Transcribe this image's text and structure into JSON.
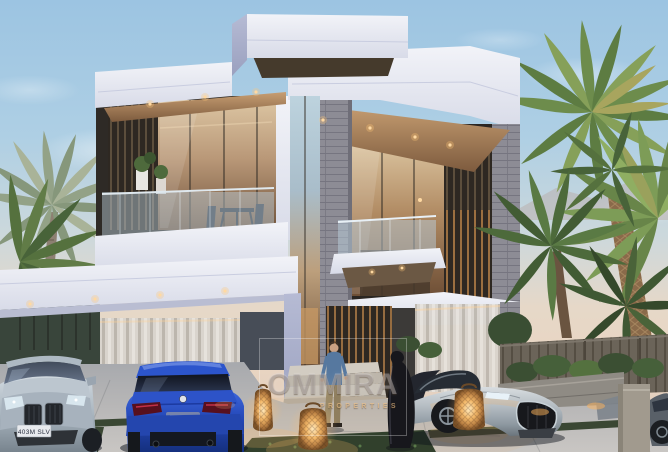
{
  "image": {
    "alt": "Dusk architectural rendering of a modern white two-storey luxury villa with glass balconies, wood-slat screens and stone piers, palm trees on both sides, a paved driveway with grass joints, glowing wicker floor lanterns, four luxury cars, a man on the entrance steps and a woman in a black abaya walking past"
  },
  "watermark": {
    "brand": "OMMIRA",
    "subtitle": "PROPERTIES"
  },
  "license_plate": "403M SLV",
  "scene": {
    "vehicles": [
      "silver BMW coupe, front view, lower left",
      "blue BMW sedan, rear view, centre left",
      "silver Bugatti-style sports car right of the entrance",
      "partially visible car at the far right edge"
    ],
    "figures": [
      "man in blue shirt and beige trousers descending the entrance steps",
      "woman in a long black abaya walking right of the entrance"
    ],
    "landscape": [
      "palm trees left and right",
      "wooden slat fence on the right",
      "stone planter wall with warm underlighting",
      "three lit wicker floor lanterns",
      "paved driveway with grass strips"
    ]
  },
  "palette": {
    "sky_top": "#9cc4e2",
    "sky_horizon": "#e9d5c2",
    "villa_white": "#e9ebf3",
    "soffit_wood": "#b08a62",
    "slat_dark": "#2e2822",
    "stone_grey": "#8d8c95",
    "glass_warm": "#b99878",
    "palm_green": "#6d8c4c",
    "driveway_grey": "#b8b7b7",
    "car_blue": "#2448b8",
    "car_silver": "#aab6c0",
    "lantern_glow": "#f3b869",
    "fence_wood": "#6b6459",
    "shirt_blue": "#56789f",
    "abaya_black": "#17171c"
  }
}
